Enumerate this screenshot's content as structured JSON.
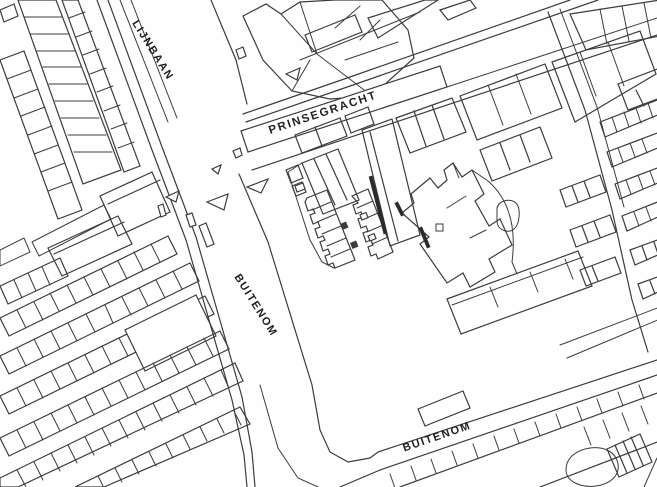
{
  "map": {
    "streets": {
      "lijnbaan": "LIJNBAAN",
      "prinsegracht": "PRINSEGRACHT",
      "buitenom_west": "BUITENOM",
      "buitenom_south": "BUITENOM"
    },
    "colors": {
      "background": "#FEFEFE",
      "line": "#3C3C3C",
      "highlight_yellow": "#F8EE58",
      "green_area": "#E8F0DB"
    }
  }
}
